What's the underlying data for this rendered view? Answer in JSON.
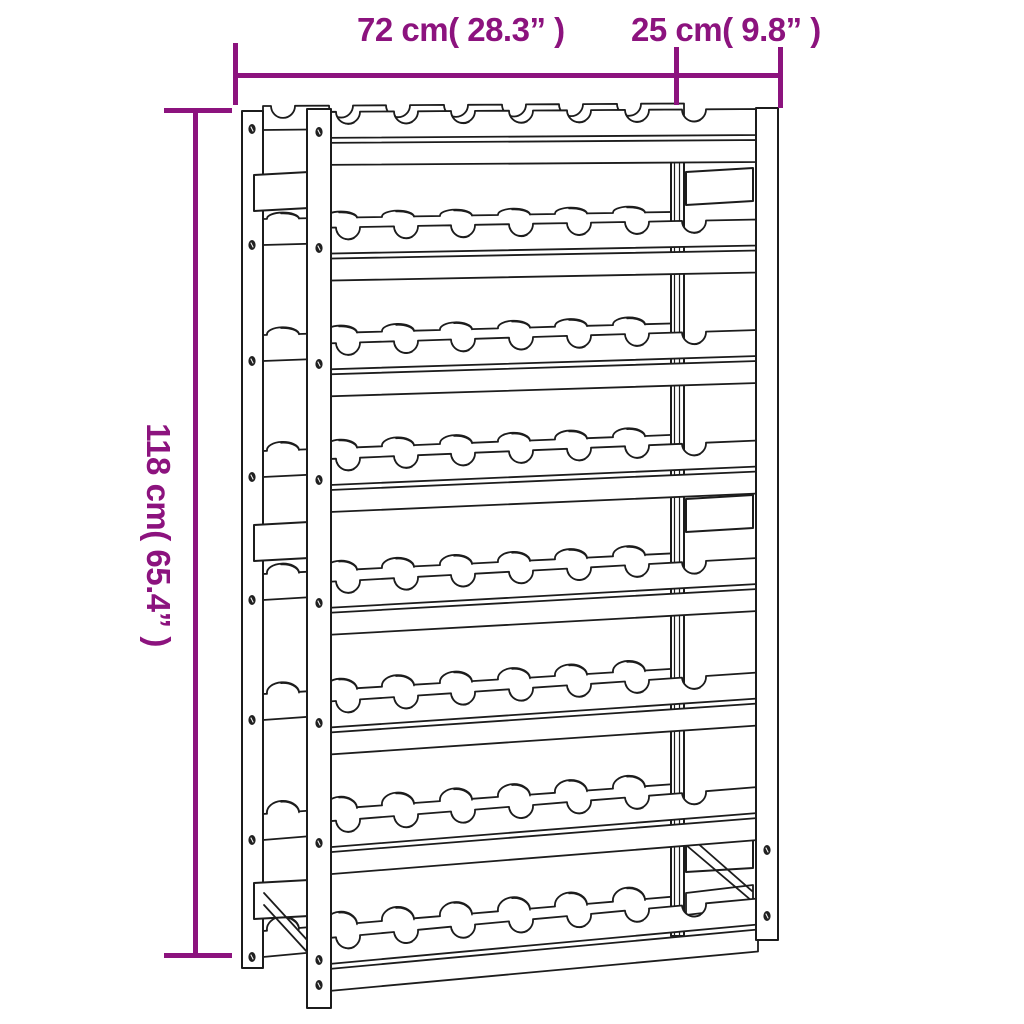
{
  "figure": {
    "type": "product-dimension-diagram",
    "subject": "wine rack line drawing",
    "rows_of_bottle_slots": 8,
    "slots_per_row": 7
  },
  "dimensions": {
    "width_label": "72 cm( 28.3” )",
    "depth_label": "25 cm( 9.8” )",
    "height_label": "118 cm( 65.4” )"
  },
  "colors": {
    "dimension_accent": "#8c137e",
    "line_art": "#1c1c1c",
    "background": "#ffffff"
  }
}
